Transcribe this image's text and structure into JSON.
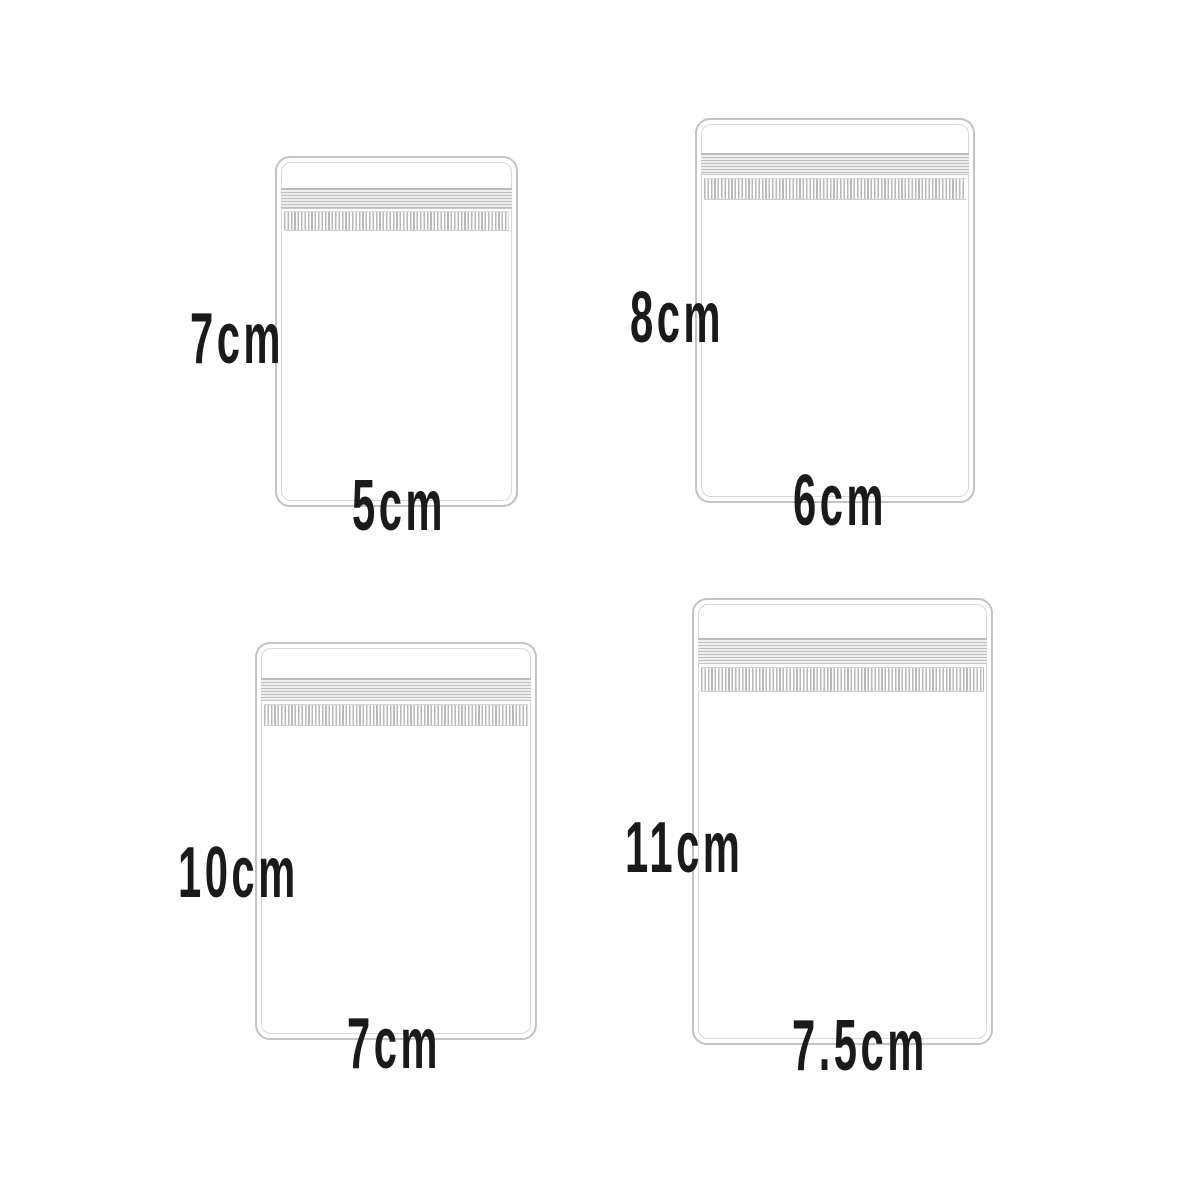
{
  "diagram": {
    "type": "product-size-diagram",
    "item": "zip-lock-bag",
    "bags": [
      {
        "height_label": "7cm",
        "width_label": "5cm"
      },
      {
        "height_label": "8cm",
        "width_label": "6cm"
      },
      {
        "height_label": "10cm",
        "width_label": "7cm"
      },
      {
        "height_label": "11cm",
        "width_label": "7.5cm"
      }
    ]
  },
  "colors": {
    "background": "#ffffff",
    "bag_outline": "#c3c3c3",
    "bag_inner_line": "#d9d9d9",
    "zipper_line": "#c0c0c0",
    "grip_line": "#b9b9b9",
    "label_text": "#1a1a1a"
  }
}
